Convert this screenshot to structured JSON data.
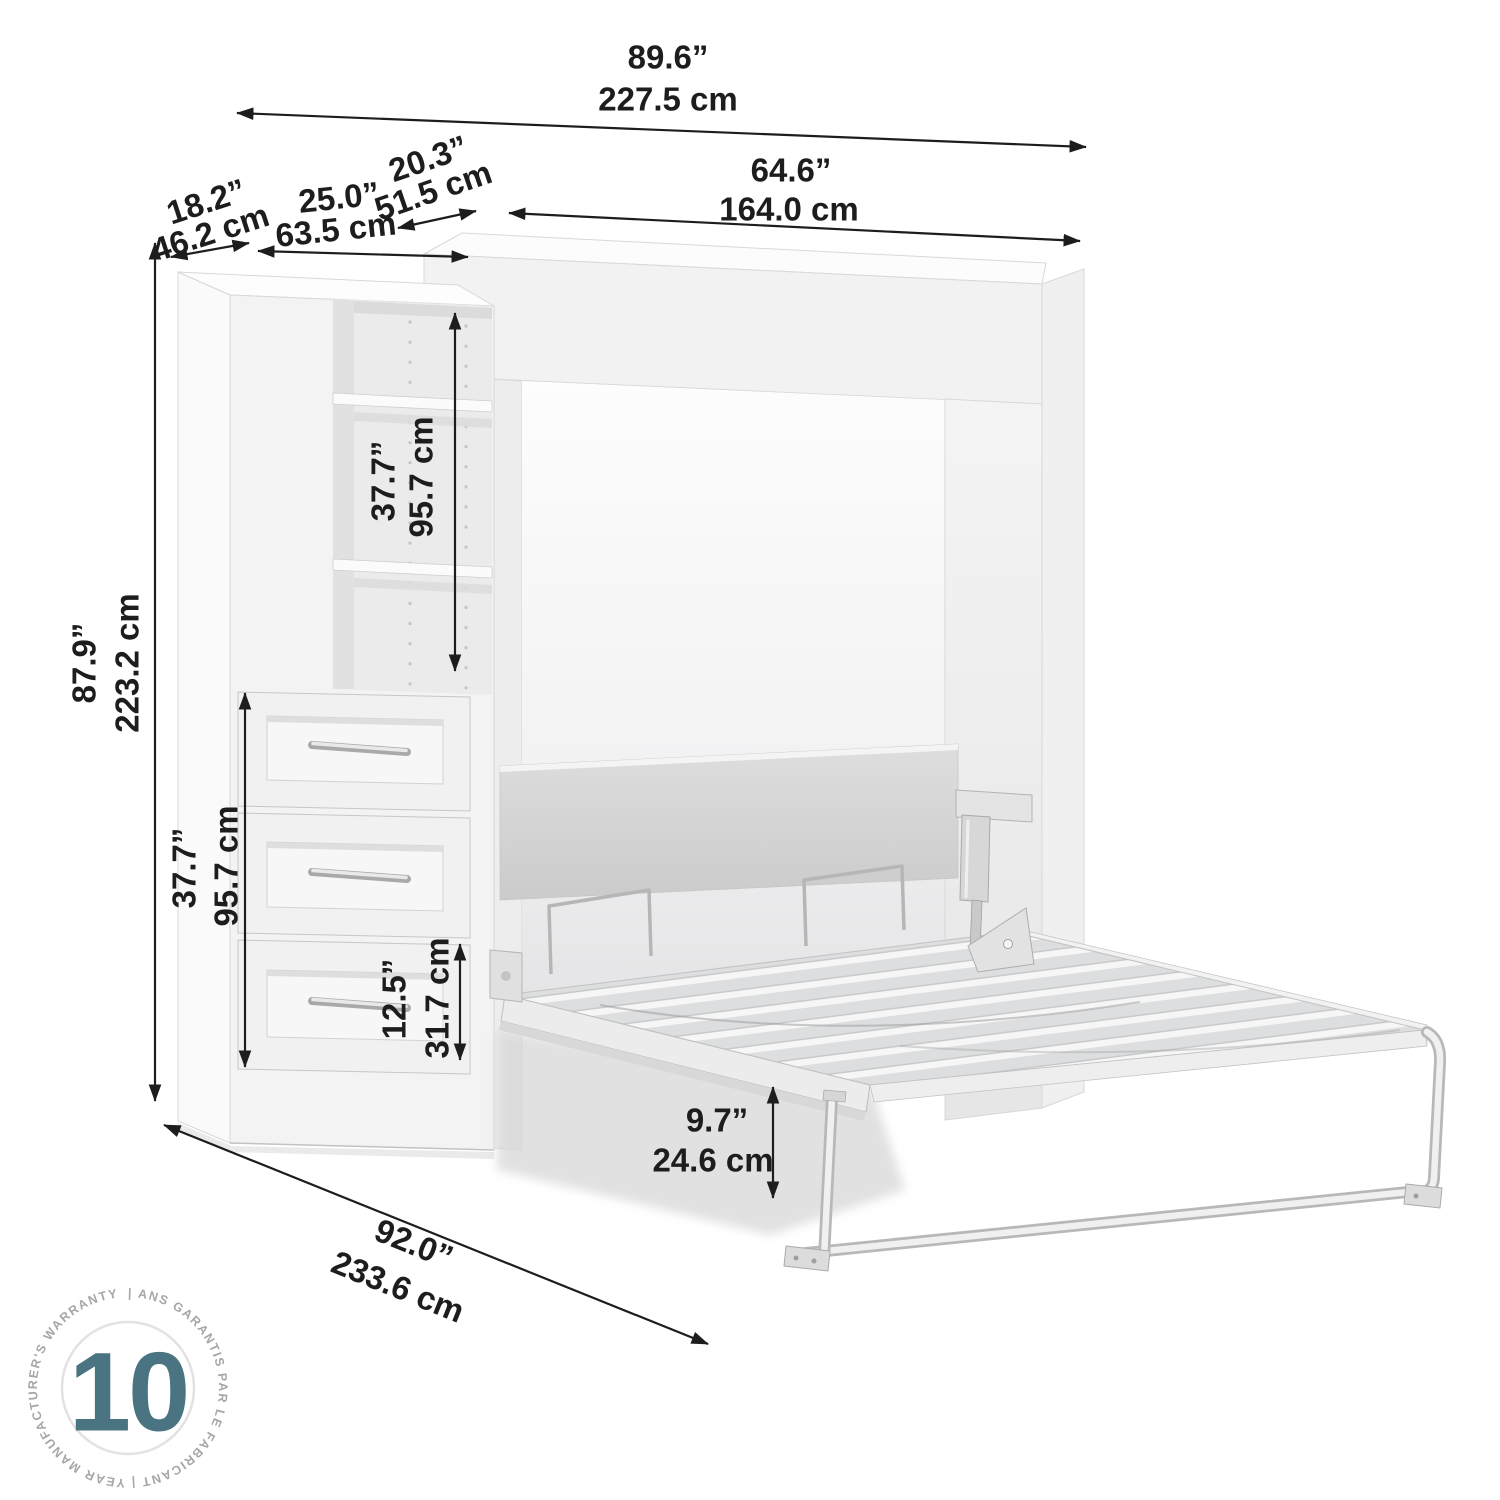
{
  "page": {
    "background": "#ffffff",
    "line_color": "#1d1d1d"
  },
  "annotations": {
    "overall_width": {
      "in": "89.6”",
      "cm": "227.5 cm"
    },
    "bed_cabinet_width": {
      "in": "64.6”",
      "cm": "164.0 cm"
    },
    "bed_cabinet_depth": {
      "in": "20.3”",
      "cm": "51.5 cm"
    },
    "shelf_unit_width": {
      "in": "25.0”",
      "cm": "63.5 cm"
    },
    "shelf_unit_depth": {
      "in": "18.2”",
      "cm": "46.2 cm"
    },
    "overall_height": {
      "in": "87.9”",
      "cm": "223.2 cm"
    },
    "shelf_section_height": {
      "in": "37.7”",
      "cm": "95.7 cm"
    },
    "drawer_section_height": {
      "in": "37.7”",
      "cm": "95.7 cm"
    },
    "bottom_drawer_height": {
      "in": "12.5”",
      "cm": "31.7 cm"
    },
    "under_bed_clearance": {
      "in": "9.7”",
      "cm": "24.6 cm"
    },
    "open_depth": {
      "in": "92.0”",
      "cm": "233.6 cm"
    }
  },
  "warranty_badge": {
    "number": "10",
    "ring_text": "| ANS GARANTIS PAR LE FABRICANT | YEAR MANUFACTURER'S WARRANTY ",
    "number_color": "#4a7482",
    "ring_text_color": "#a6a6a6"
  }
}
